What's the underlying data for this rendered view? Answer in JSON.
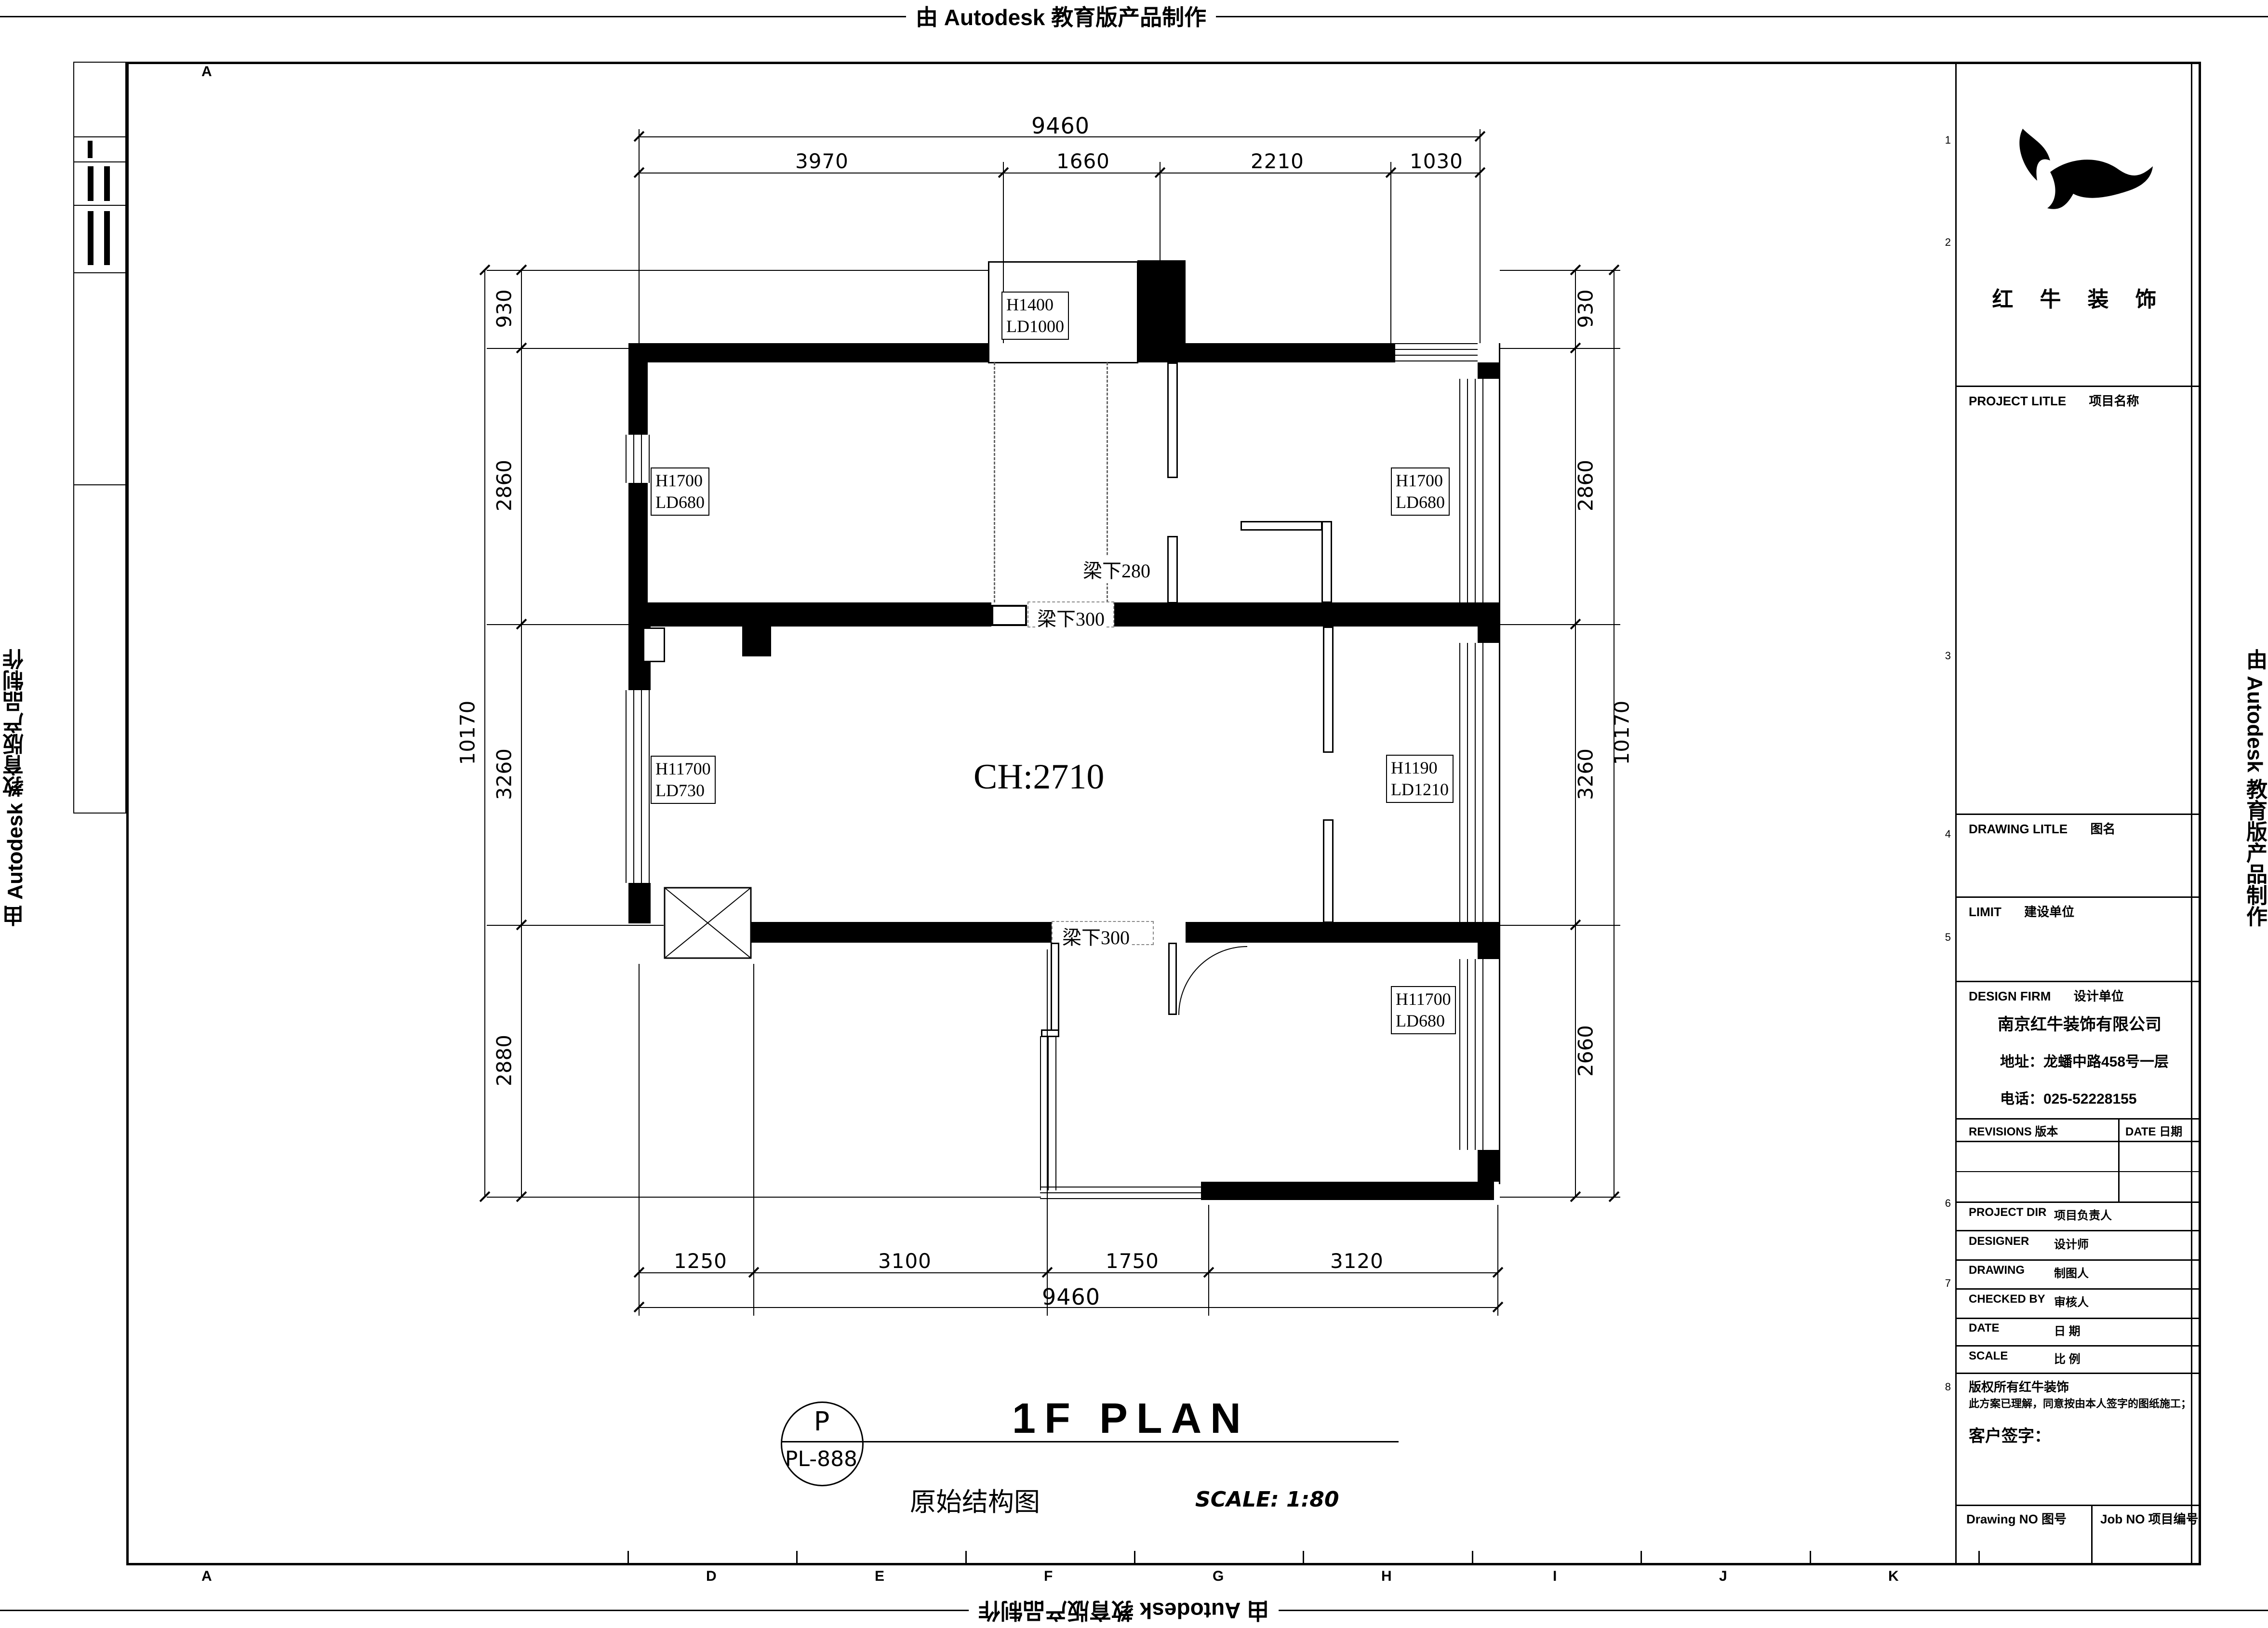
{
  "banner": {
    "text": "由 Autodesk 教育版产品制作"
  },
  "frame": {
    "grid_letter_top": "A",
    "grid_letters_bottom": [
      "A",
      "D",
      "E",
      "F",
      "G",
      "H",
      "I",
      "J",
      "K"
    ],
    "grid_numbers_right": [
      "1",
      "2",
      "3",
      "4",
      "5",
      "6",
      "7",
      "8"
    ]
  },
  "title_block": {
    "brand": "红 牛 装 饰",
    "project_title_en": "PROJECT LITLE",
    "project_title_cn": "项目名称",
    "drawing_title_en": "DRAWING LITLE",
    "drawing_title_cn": "图名",
    "client_en": "LIMIT",
    "client_cn": "建设单位",
    "design_firm_en": "DESIGN FIRM",
    "design_firm_cn": "设计单位",
    "company": "南京红牛装饰有限公司",
    "address": "地址：龙蟠中路458号一层",
    "phone": "电话：025-52228155",
    "revisions": "REVISIONS 版本",
    "date_col": "DATE 日期",
    "rows": [
      {
        "en": "PROJECT DIR",
        "cn": "项目负责人"
      },
      {
        "en": "DESIGNER",
        "cn": "设计师"
      },
      {
        "en": "DRAWING",
        "cn": "制图人"
      },
      {
        "en": "CHECKED BY",
        "cn": "审核人"
      },
      {
        "en": "DATE",
        "cn": "日  期"
      },
      {
        "en": "SCALE",
        "cn": "比  例"
      }
    ],
    "note1": "版权所有红牛装饰",
    "note2": "此方案已理解，同意按由本人签字的图纸施工；",
    "sign": "客户签字：",
    "drawing_no": "Drawing NO  图号",
    "job_no": "Job NO  项目编号"
  },
  "plan": {
    "ch": "CH:2710",
    "rooms": [
      {
        "l1": "H1400",
        "l2": "LD1000"
      },
      {
        "l1": "H1700",
        "l2": "LD680"
      },
      {
        "l1": "H1700",
        "l2": "LD680"
      },
      {
        "l1": "H11700",
        "l2": "LD730"
      },
      {
        "l1": "H1190",
        "l2": "LD1210"
      },
      {
        "l1": "H11700",
        "l2": "LD680"
      }
    ],
    "beams": [
      "梁下280",
      "梁下300",
      "梁下300"
    ],
    "dims": {
      "top": {
        "overall": "9460",
        "segs": [
          "3970",
          "1660",
          "2210",
          "1030"
        ]
      },
      "bottom": {
        "overall": "9460",
        "segs": [
          "1250",
          "3100",
          "1750",
          "3120"
        ]
      },
      "left": {
        "overall": "10170",
        "segs": [
          "930",
          "2860",
          "3260",
          "2880"
        ]
      },
      "right": {
        "overall": "10170",
        "segs": [
          "930",
          "2860",
          "3260",
          "2660"
        ]
      }
    }
  },
  "titlebar": {
    "bubble_letter": "P",
    "bubble_code": "PL-888",
    "title": "1F PLAN",
    "subtitle": "原始结构图",
    "scale": "SCALE:  1:80"
  }
}
